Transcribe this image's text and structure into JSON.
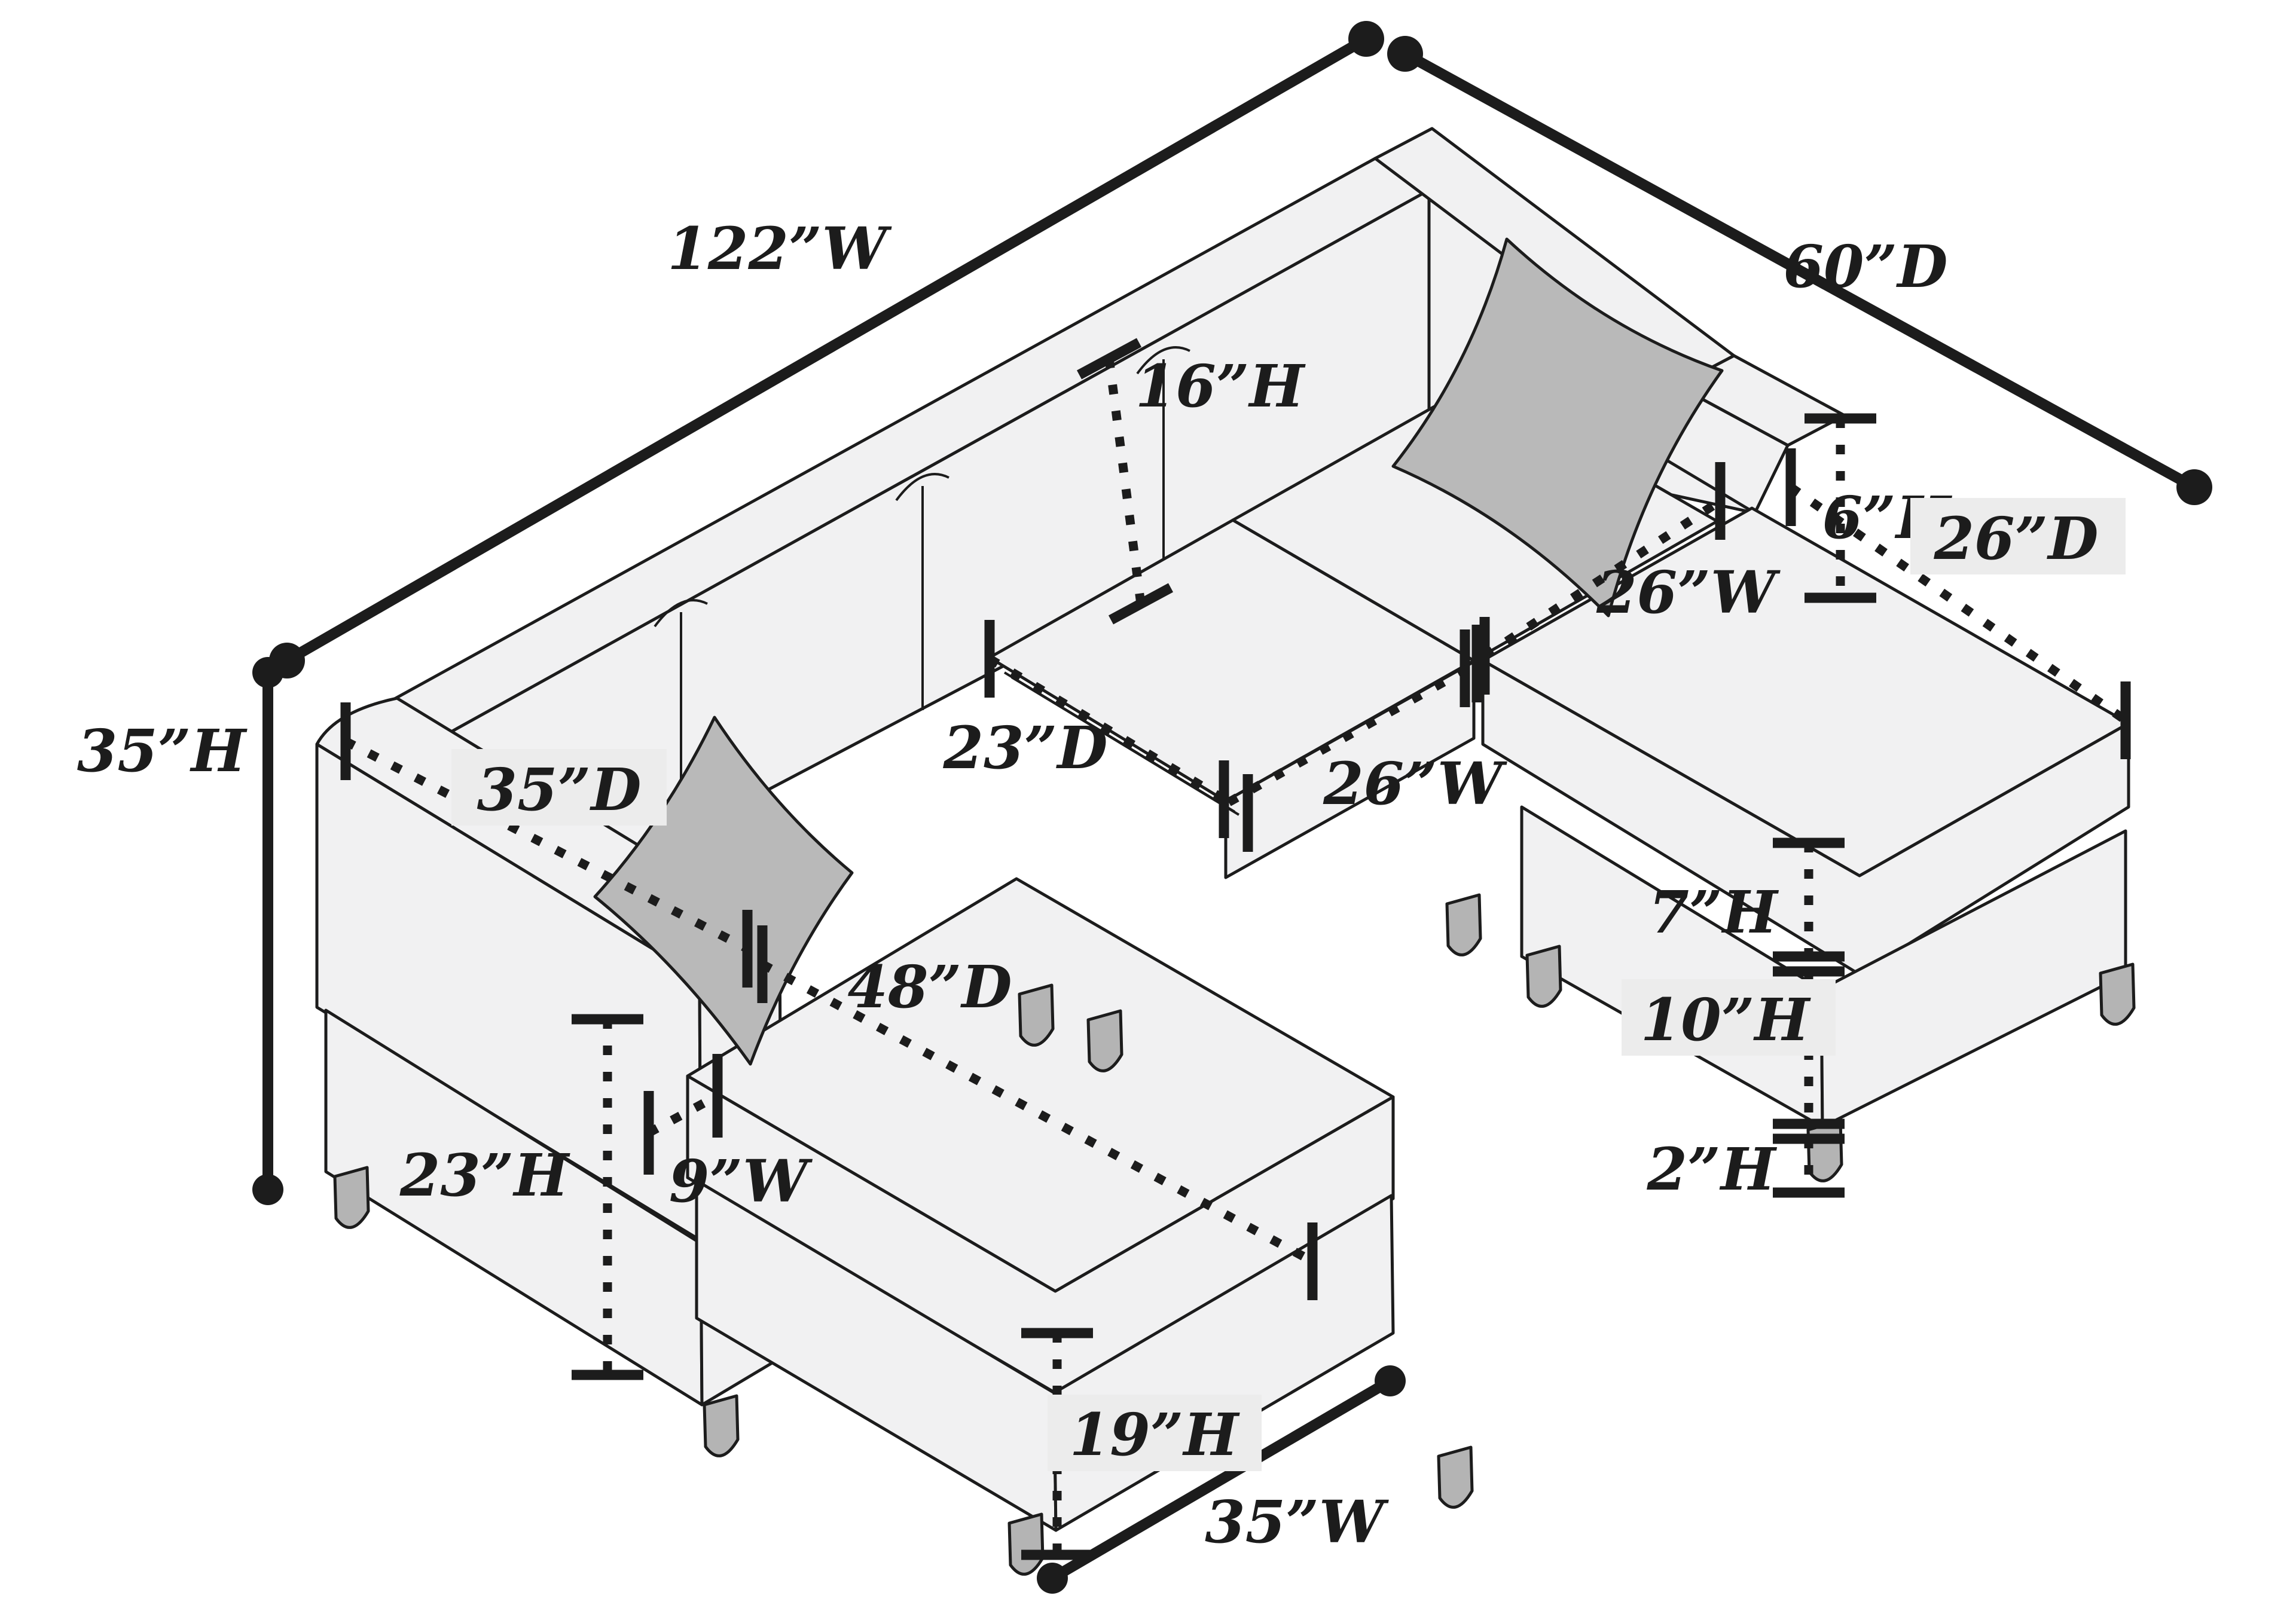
{
  "diagram": {
    "type": "furniture-dimension-diagram",
    "subject": "u-shaped sectional sofa with two chaises and pillows, isometric line drawing",
    "labels": {
      "w122": "122”W",
      "d60": "60”D",
      "h35": "35”H",
      "h16": "16”H",
      "h6": "6”H",
      "d26": "26”D",
      "w26_right": "26”W",
      "d23": "23”D",
      "w26_center": "26”W",
      "d35": "35”D",
      "d48": "48”D",
      "h7": "7”H",
      "h10": "10”H",
      "h2": "2”H",
      "h23": "23”H",
      "w9": "9”W",
      "h19": "19”H",
      "w35": "35”W"
    },
    "colors": {
      "background": "#ffffff",
      "outline": "#1c1c1c",
      "sofa_fill": "#f1f1f2",
      "pillow_fill": "#b9b9b9",
      "leg_fill": "#b4b4b4",
      "label_bg": "#ececec"
    }
  }
}
